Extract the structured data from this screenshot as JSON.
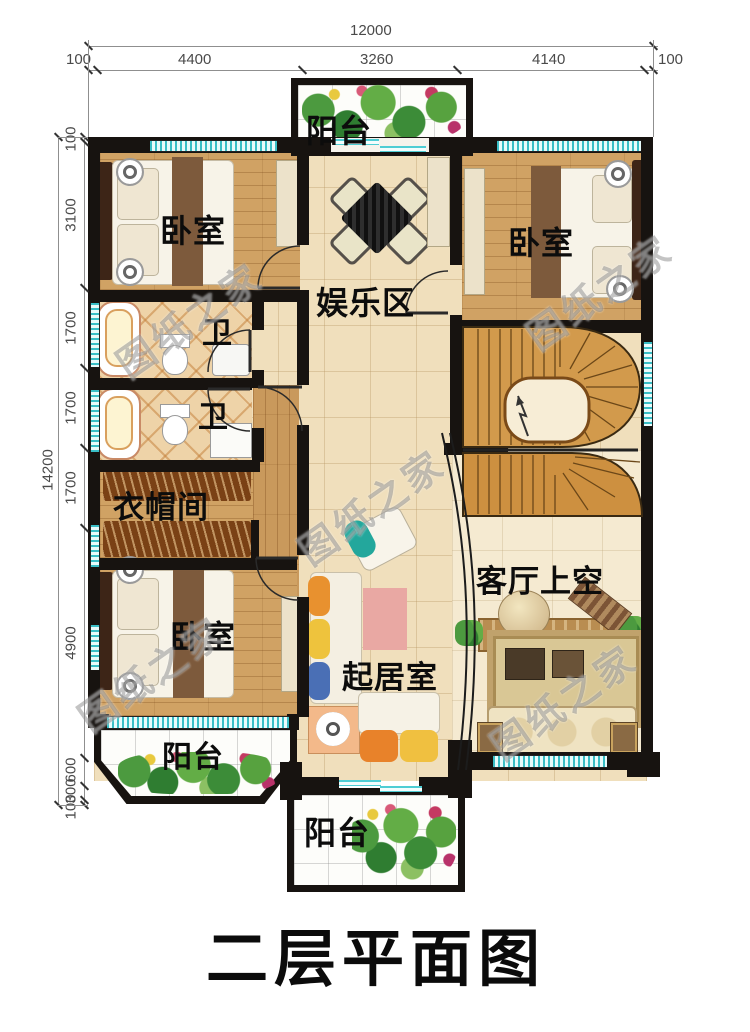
{
  "title": "二层平面图",
  "watermark": "图纸之家",
  "dims": {
    "top": {
      "total": "12000",
      "segments": [
        "100",
        "4400",
        "3260",
        "4140",
        "100"
      ]
    },
    "left": {
      "total": "14200",
      "segments": [
        "100",
        "3100",
        "1700",
        "1700",
        "1700",
        "4900",
        "600",
        "300",
        "100"
      ]
    }
  },
  "rooms": {
    "balcony_top": "阳台",
    "bedroom_tl": "卧室",
    "bedroom_tr": "卧室",
    "entertainment": "娱乐区",
    "bath_1": "卫",
    "bath_2": "卫",
    "cloakroom": "衣帽间",
    "bedroom_bl": "卧室",
    "sitting_room": "起居室",
    "living_void": "客厅上空",
    "balcony_bl": "阳台",
    "balcony_bottom": "阳台"
  },
  "colors": {
    "wall": "#171310",
    "window_teal": "#39bec6",
    "floor_tile": "#f0dfbc",
    "floor_wood": "#d0a264",
    "stair_wood": "#d29a4c",
    "watermark_gray": "#696969"
  }
}
